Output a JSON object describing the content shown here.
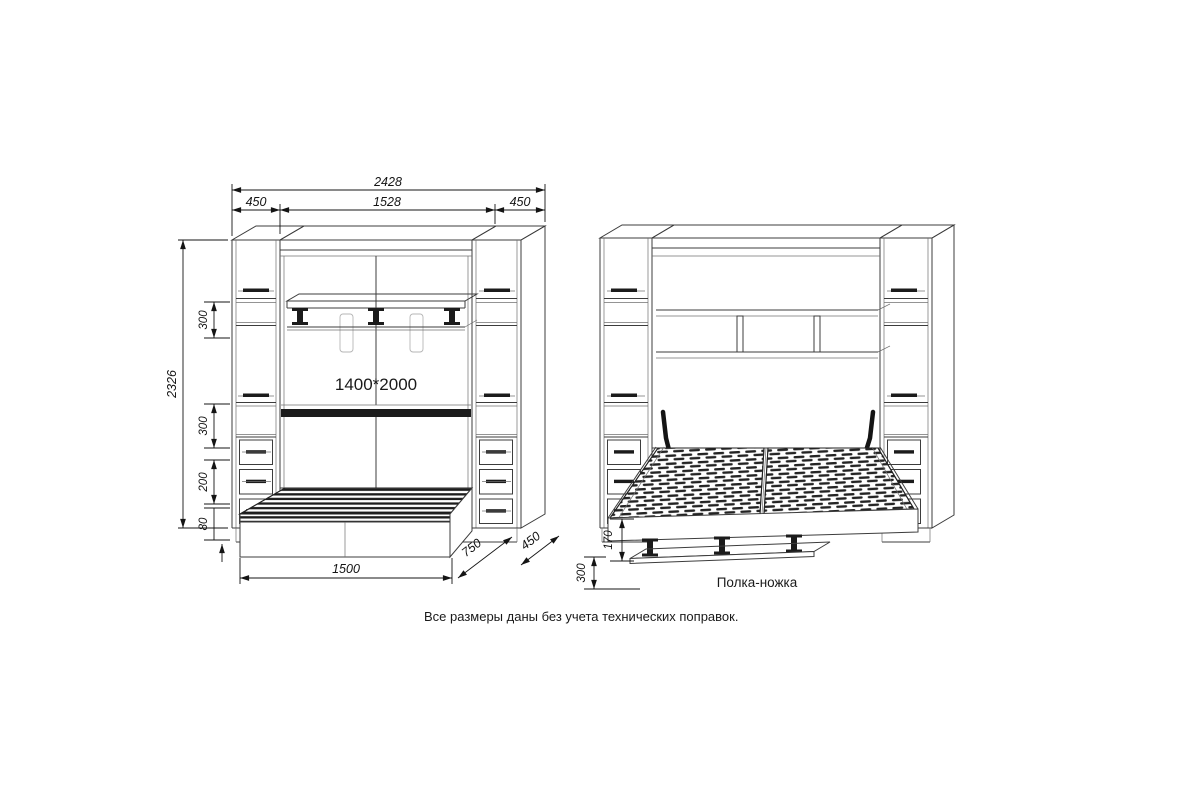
{
  "colors": {
    "background": "#ffffff",
    "line": "#3c3c3c",
    "dark": "#1b1b1b",
    "text": "#141414"
  },
  "note": "Все размеры даны без учета технических поправок.",
  "closed_view": {
    "bed_size_label": "1400*2000",
    "dims": {
      "total_width": "2428",
      "left_cabinet_width": "450",
      "center_width": "1528",
      "right_cabinet_width": "450",
      "total_height": "2326",
      "shelf_gap_upper": "300",
      "shelf_gap_middle": "300",
      "drawer_zone": "200",
      "plinth_height": "80",
      "base_length": "1500",
      "bed_depth": "750",
      "cabinet_depth": "450"
    }
  },
  "open_view": {
    "labels": {
      "shelf_leg": "Полка-ножка"
    },
    "dims": {
      "platform_height": "170",
      "shelf_leg_height": "300"
    }
  }
}
